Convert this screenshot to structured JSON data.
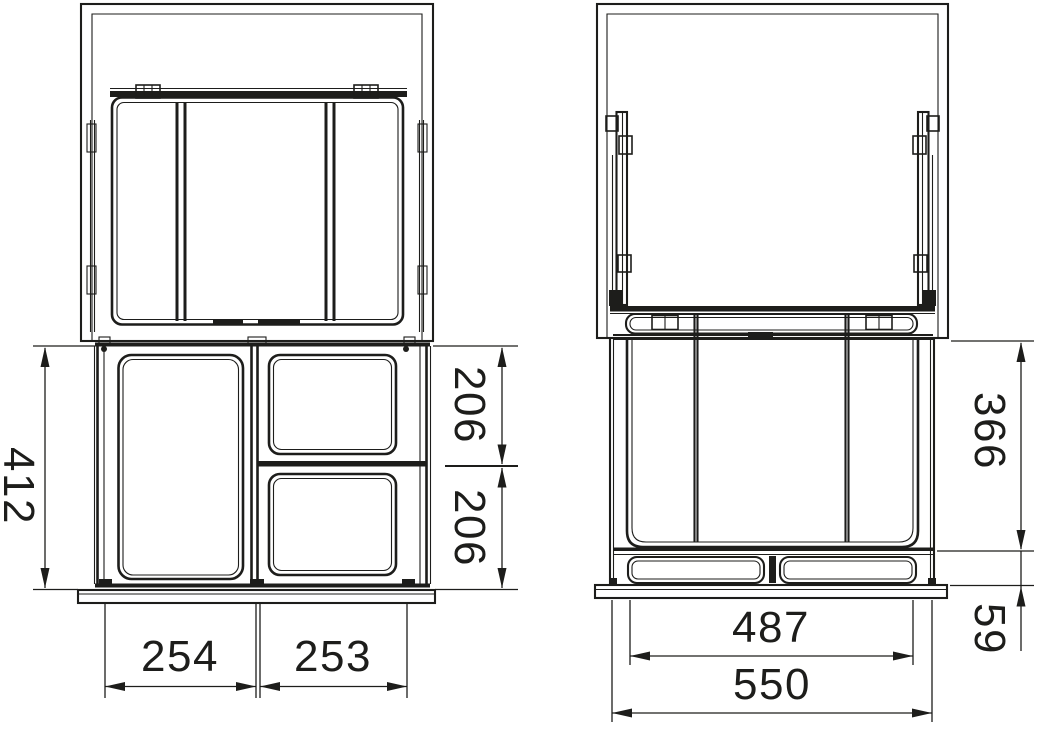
{
  "canvas": {
    "background": "#ffffff",
    "line_color": "#1d1d1b",
    "description": "Technical dimension drawing of a pull-out waste bin unit, front/top view (left) and side view (right)"
  },
  "dims": {
    "front_total_height": "412",
    "front_upper_bin_height": "206",
    "front_lower_bin_height": "206",
    "front_left_bin_width": "254",
    "front_right_bin_width": "253",
    "side_bin_height": "366",
    "side_base_height": "59",
    "side_inner_depth": "487",
    "side_total_depth": "550"
  }
}
